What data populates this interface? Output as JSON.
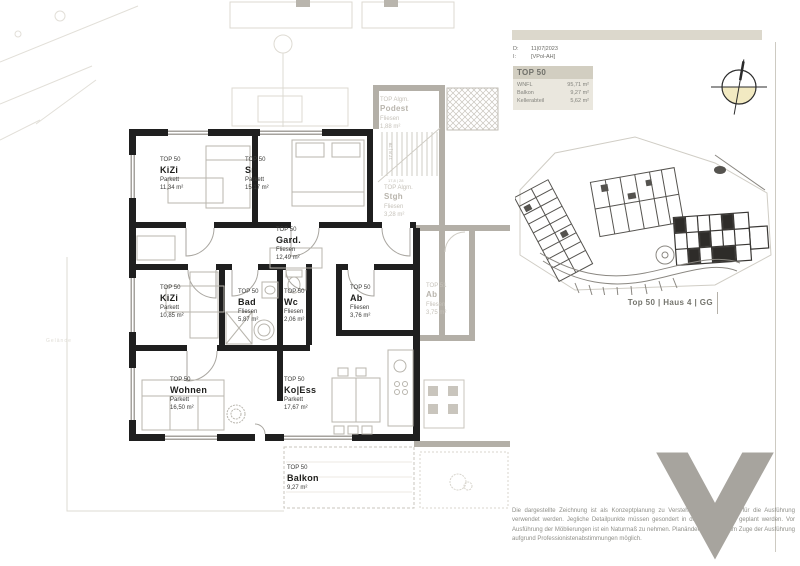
{
  "header": {
    "date_label": "D:",
    "date_value": "11|07|2023",
    "rev_label": "I:",
    "rev_value": "[VPol-AH]"
  },
  "unit": {
    "title": "TOP 50",
    "rows": [
      {
        "label": "WNFL",
        "value": "95,71 m²"
      },
      {
        "label": "Balkon",
        "value": "9,27 m²"
      },
      {
        "label": "Kellerabteil",
        "value": "5,62 m²"
      }
    ]
  },
  "site": {
    "caption": "Top 50 | Haus 4 | GG"
  },
  "disclaimer": "Die dargestellte Zeichnung ist als Konzeptplanung zu Verstehen und darf nicht für die Ausführung verwendet werden. Jegliche Detailpunkte müssen gesondert in der Werkplanung geplant werden. Vor Ausführung der Möblierungen ist ein Naturmaß zu nehmen. Planänderungen sind im Zuge der Ausführung aufgrund Professionistenabstimmungen möglich.",
  "plan": {
    "stair_note": "17,8 | 28",
    "terrain_label": "Gelände"
  },
  "rooms": [
    {
      "top": "TOP 50",
      "name": "KiZi",
      "floor": "Parkett",
      "area": "11,34 m²"
    },
    {
      "top": "TOP 50",
      "name": "Sr",
      "floor": "Parkett",
      "area": "15,17 m²"
    },
    {
      "top": "TOP 50",
      "name": "Gard.",
      "floor": "Fliesen",
      "area": "12,49 m²"
    },
    {
      "top": "TOP 50",
      "name": "KiZi",
      "floor": "Parkett",
      "area": "10,85 m²"
    },
    {
      "top": "TOP 50",
      "name": "Bad",
      "floor": "Fliesen",
      "area": "5,87 m²"
    },
    {
      "top": "TOP 50",
      "name": "Wc",
      "floor": "Fliesen",
      "area": "2,06 m²"
    },
    {
      "top": "TOP 50",
      "name": "Ab",
      "floor": "Fliesen",
      "area": "3,76 m²"
    },
    {
      "top": "TOP 50",
      "name": "Wohnen",
      "floor": "Parkett",
      "area": "16,50 m²"
    },
    {
      "top": "TOP 50",
      "name": "Ko|Ess",
      "floor": "Parkett",
      "area": "17,67 m²"
    },
    {
      "top": "TOP 50",
      "name": "Balkon",
      "floor": "",
      "area": "9,27 m²"
    }
  ],
  "neighbors": [
    {
      "top": "TOP Algm.",
      "name": "Podest",
      "floor": "Fliesen",
      "area": "1,88 m²"
    },
    {
      "top": "TOP Algm.",
      "name": "Stgh",
      "floor": "Fliesen",
      "area": "3,28 m²"
    },
    {
      "top": "TOP 51",
      "name": "Ab",
      "floor": "Fliesen",
      "area": "3,75 m²"
    }
  ],
  "colors": {
    "wall_black": "#1f1f1f",
    "wall_gray": "#b3afa7",
    "header_beige": "#d2cec1",
    "panel_beige": "#eae7de",
    "compass_fill": "#f2eac2",
    "logo_gray": "#a7a49e"
  }
}
